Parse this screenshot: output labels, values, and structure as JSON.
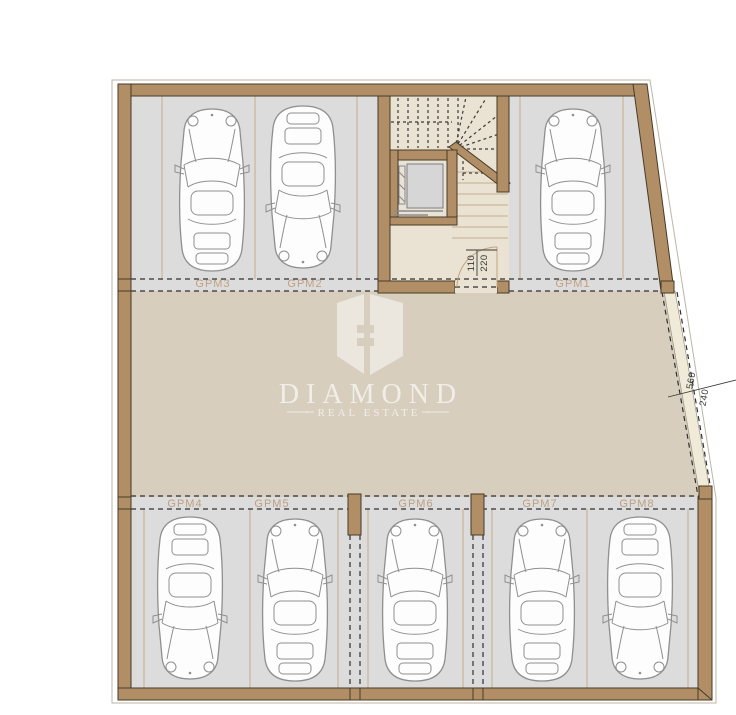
{
  "floor_plan": {
    "spots_top": [
      {
        "label": "GPM3"
      },
      {
        "label": "GPM2"
      },
      {
        "label": "GPM1"
      }
    ],
    "spots_bottom": [
      {
        "label": "GPM4"
      },
      {
        "label": "GPM5"
      },
      {
        "label": "GPM6"
      },
      {
        "label": "GPM7"
      },
      {
        "label": "GPM8"
      }
    ],
    "dimensions": {
      "stair_door": {
        "numerator": "110",
        "denominator": "220"
      },
      "garage_entry": {
        "numerator": "560",
        "denominator": "240"
      }
    }
  },
  "watermark": {
    "title": "DIAMOND",
    "tagline": "· REAL ESTATE ·"
  },
  "colors": {
    "wall": "#b18e66",
    "parking_floor": "#dcdcdd",
    "drive_floor": "#d7cebe",
    "stairwell_floor": "#eae3d3",
    "spot_label": "#c09f7e",
    "dashed_line": "#2f2f2f",
    "background": "#ffffff"
  }
}
